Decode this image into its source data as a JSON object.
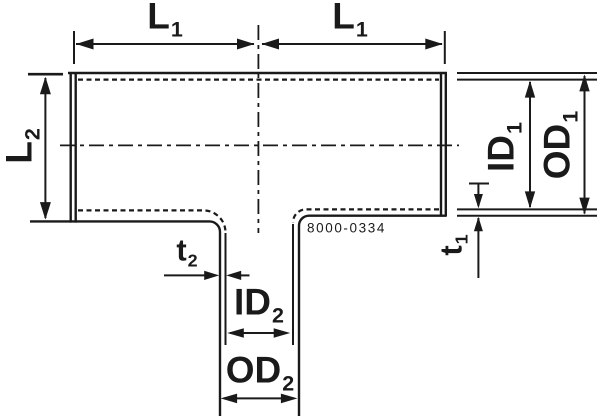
{
  "drawing": {
    "background": "#ffffff",
    "line_color": "#1a1a1a",
    "part_number": "8000-0334",
    "labels": {
      "l1_left": {
        "main": "L",
        "sub": "1"
      },
      "l1_right": {
        "main": "L",
        "sub": "1"
      },
      "l2": {
        "main": "L",
        "sub": "2"
      },
      "id1": {
        "main": "ID",
        "sub": "1"
      },
      "od1": {
        "main": "OD",
        "sub": "1"
      },
      "t1": {
        "main": "t",
        "sub": "1"
      },
      "t2": {
        "main": "t",
        "sub": "2"
      },
      "id2": {
        "main": "ID",
        "sub": "2"
      },
      "od2": {
        "main": "OD",
        "sub": "2"
      }
    }
  }
}
